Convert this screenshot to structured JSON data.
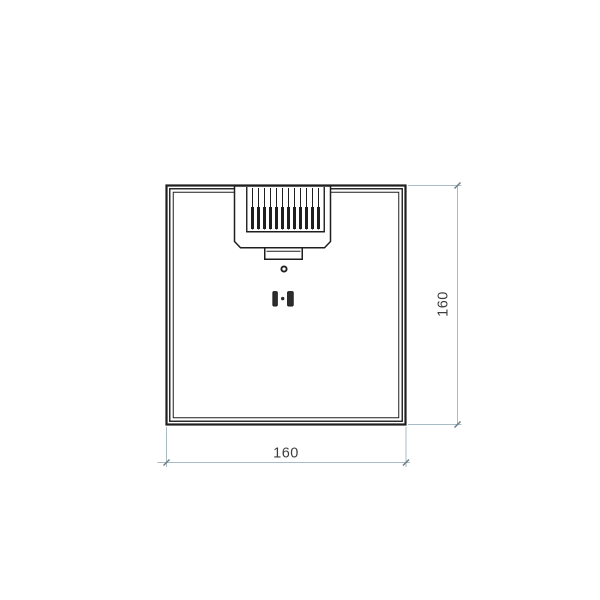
{
  "drawing": {
    "dimension_width": {
      "label": "160"
    },
    "dimension_height": {
      "label": "160"
    },
    "connector": {
      "pin_count": 12
    },
    "colors": {
      "line": "#1f1f1f",
      "dim_line": "#a7bcc4",
      "tick": "#6e7f88",
      "dim_text": "#3d3d3d",
      "slot_fill": "#2d2d2d",
      "background": "#ffffff"
    }
  }
}
